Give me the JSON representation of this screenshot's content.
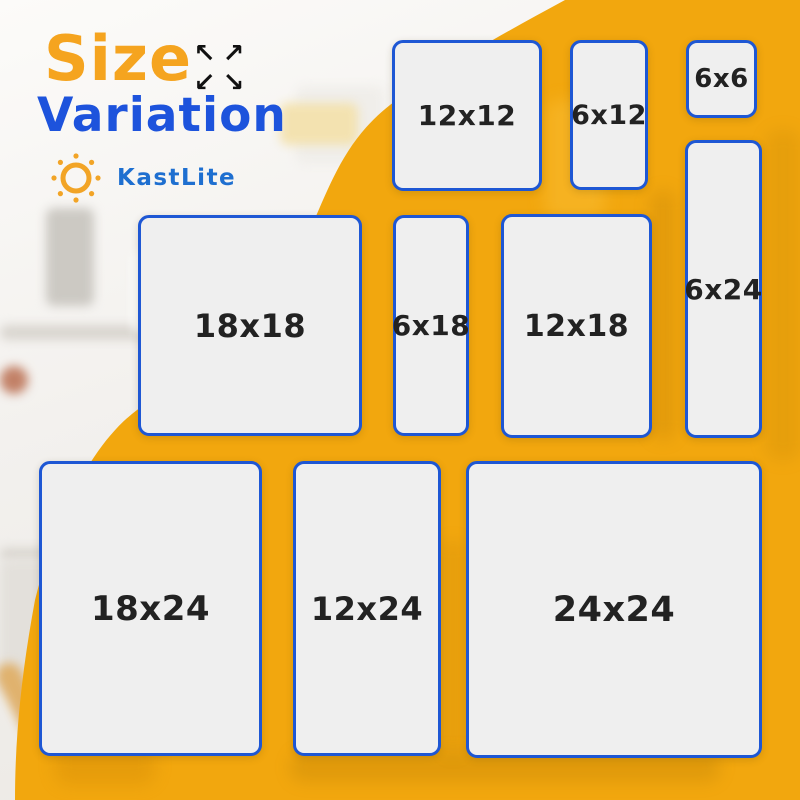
{
  "header": {
    "title_line1": "Size",
    "title_line2": "Variation",
    "expand_icon": {
      "arrows": [
        "↖",
        "↗",
        "↙",
        "↘"
      ]
    }
  },
  "brand": {
    "name": "KastLite"
  },
  "tiles": [
    {
      "label": "12x12"
    },
    {
      "label": "6x12"
    },
    {
      "label": "6x6"
    },
    {
      "label": "6x24"
    },
    {
      "label": "18x18"
    },
    {
      "label": "6x18"
    },
    {
      "label": "12x18"
    },
    {
      "label": "18x24"
    },
    {
      "label": "12x24"
    },
    {
      "label": "24x24"
    }
  ],
  "colors": {
    "bg-yellow": "#F2A70E",
    "title-orange": "#F5A41F",
    "title-blue": "#1D53DC",
    "brand-blue": "#1E6FD0",
    "logo-orange": "#F2A426",
    "tile-border": "#1E57D4",
    "tile-fill": "#EFEFEF",
    "label-dark": "#222222",
    "arrow-black": "#111111"
  }
}
